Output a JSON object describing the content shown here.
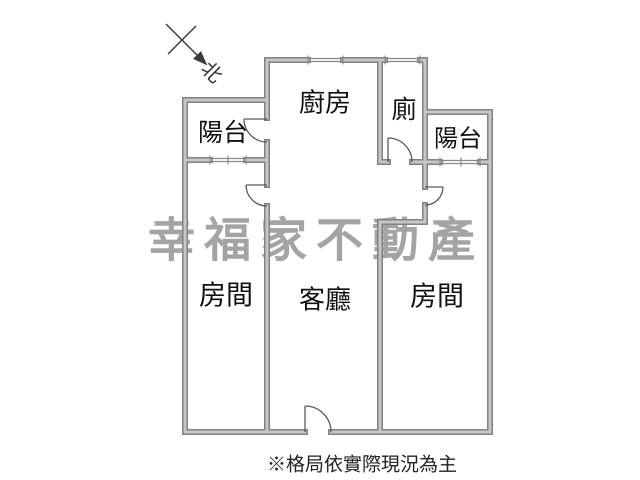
{
  "north_indicator": {
    "label": "北"
  },
  "rooms": [
    {
      "id": "balcony-left",
      "label": "陽台"
    },
    {
      "id": "kitchen",
      "label": "廚房"
    },
    {
      "id": "toilet",
      "label": "廁"
    },
    {
      "id": "balcony-right",
      "label": "陽台"
    },
    {
      "id": "bedroom-left",
      "label": "房間"
    },
    {
      "id": "living-room",
      "label": "客廳"
    },
    {
      "id": "bedroom-right",
      "label": "房間"
    }
  ],
  "watermark": {
    "text": "幸福家不動產",
    "color": "#9d9d9d"
  },
  "footnote": {
    "text": "※格局依實際現況為主"
  },
  "colors": {
    "wall_edge": "#828282",
    "wall_fill": "#c6c6c6",
    "door_line": "#5a5a5a",
    "window_line": "#8a8a8a",
    "label_text": "#111111"
  }
}
